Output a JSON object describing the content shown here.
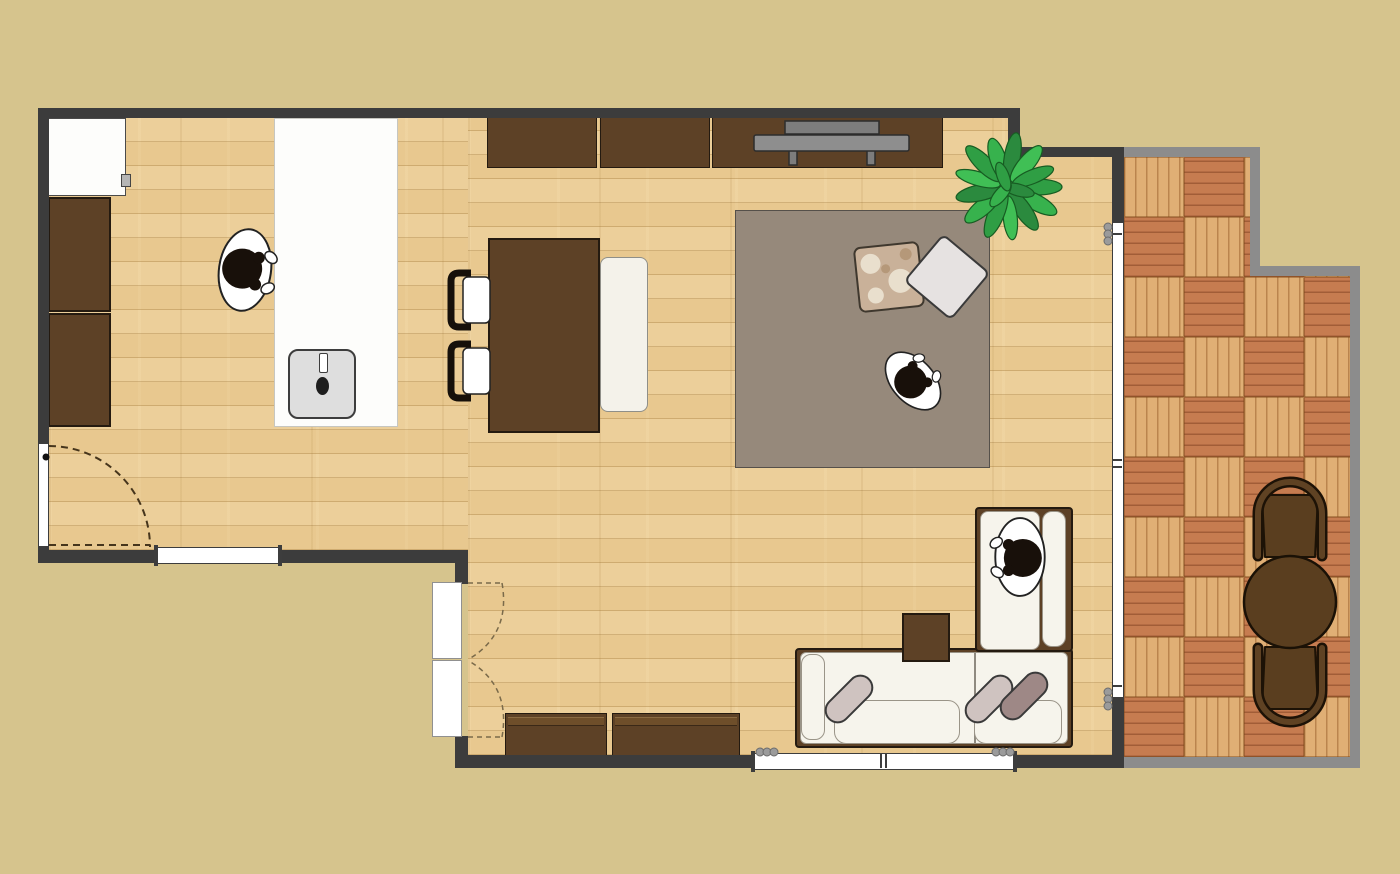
{
  "app": {
    "name": "room-floor-plan"
  },
  "palette": {
    "background": "#d6c48d",
    "wall": "#3c3c3c",
    "balcony_wall": "#8c8c8c",
    "floor_wood": "#eccf9a",
    "balcony_tile_light": "#e0af75",
    "balcony_tile_red": "#c67c50",
    "furniture_brown": "#5d4126",
    "rug": "#96897b",
    "sofa_cushion": "#f6f4ec",
    "pillow_light": "#cfc3c0",
    "pillow_mauve": "#9e8886",
    "plant_green": "#2f9e44",
    "tv_gray": "#8e8e8e",
    "sink_gray": "#dedede",
    "hair_black": "#18100a"
  },
  "balcony": {
    "tile_size": 60,
    "cols": 4,
    "rows": 10
  },
  "items": {
    "fridge": "Refrigerator",
    "cabinet_upper": "Kitchen tall cabinet",
    "cabinet_lower": "Kitchen tall cabinet",
    "island": "Kitchen island counter",
    "sink": "Kitchen sink",
    "stool_person": "Person seated at counter",
    "dining_table": "Dining table",
    "dining_bench": "Dining bench",
    "dining_chair_1": "Dining chair",
    "dining_chair_2": "Dining chair",
    "tv_board_1": "Wall cabinet",
    "tv_board_2": "Wall cabinet",
    "tv_board_3": "TV board",
    "tv": "Television",
    "rug": "Area rug",
    "pillow_floral": "Floral floor cushion",
    "pillow_plain": "Plain floor cushion",
    "person_rug": "Person seated on rug",
    "plant": "Potted plant",
    "sofa": "L-shaped sofa",
    "person_sofa": "Person seated on sofa chaise",
    "end_table": "Square side table",
    "low_board_1": "Low cabinet",
    "low_board_2": "Low cabinet",
    "entry_door": "Entry door with swing",
    "kitchen_window": "Kitchen window",
    "bottom_window": "Sliding window",
    "balcony_door": "Sliding balcony door",
    "bifold_door": "Bi-fold closet door",
    "balcony_table": "Outdoor round table",
    "balcony_chair_top": "Outdoor chair",
    "balcony_chair_bottom": "Outdoor chair"
  }
}
